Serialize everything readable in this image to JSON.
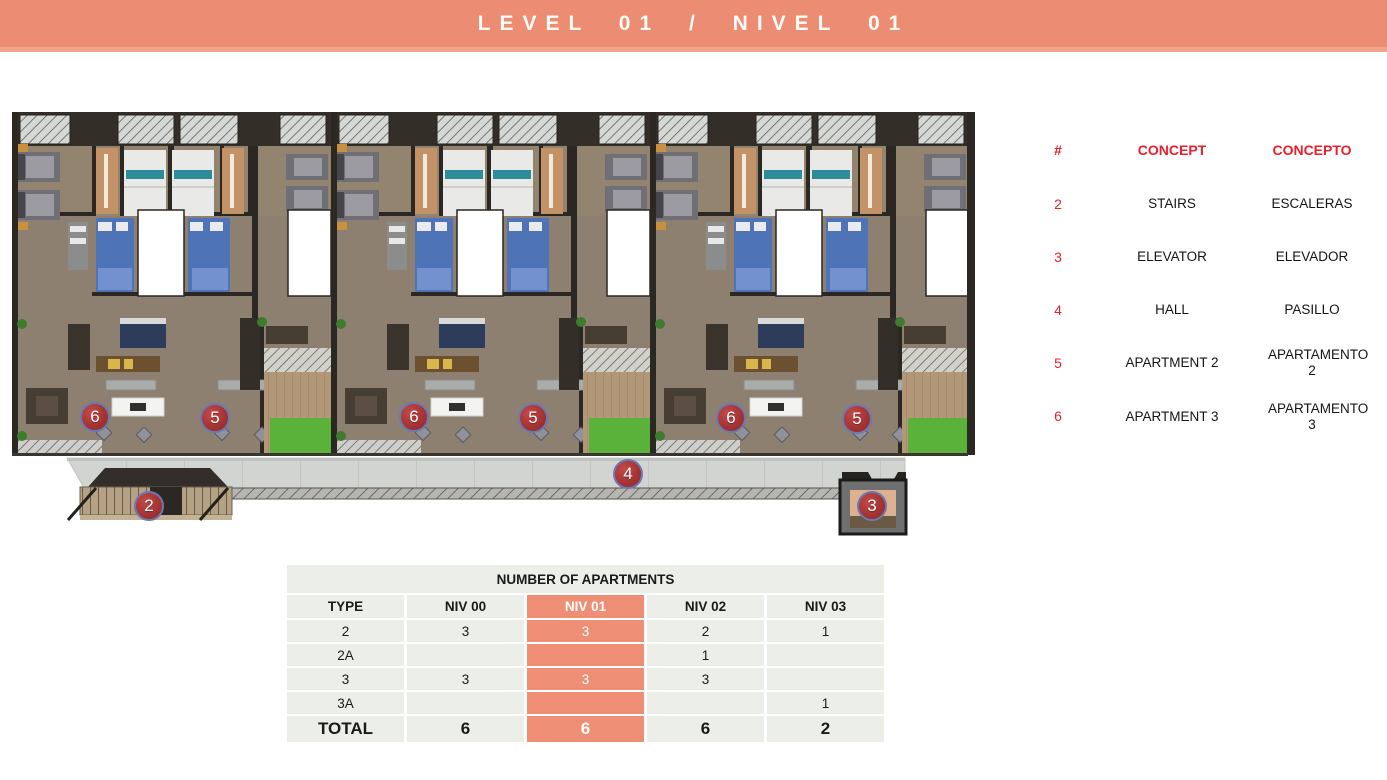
{
  "header": {
    "title": "LEVEL 01 / NIVEL 01"
  },
  "colors": {
    "accent_salmon": "#EC8C72",
    "highlight_salmon": "#EE8E74",
    "legend_red": "#E8202C",
    "marker_red": "#A33232",
    "marker_ring_blue": "#6A79B4",
    "table_cell_bg": "#ECEFE7"
  },
  "legend": {
    "headers": [
      "#",
      "CONCEPT",
      "CONCEPTO"
    ],
    "rows": [
      {
        "num": "2",
        "concept": "STAIRS",
        "concepto": "ESCALERAS"
      },
      {
        "num": "3",
        "concept": "ELEVATOR",
        "concepto": "ELEVADOR"
      },
      {
        "num": "4",
        "concept": "HALL",
        "concepto": "PASILLO"
      },
      {
        "num": "5",
        "concept": "APARTMENT 2",
        "concepto": "APARTAMENTO 2"
      },
      {
        "num": "6",
        "concept": "APARTMENT 3",
        "concepto": "APARTAMENTO 3"
      }
    ]
  },
  "floor_plan": {
    "markers": [
      {
        "label": "6"
      },
      {
        "label": "5"
      },
      {
        "label": "6"
      },
      {
        "label": "5"
      },
      {
        "label": "6"
      },
      {
        "label": "5"
      },
      {
        "label": "4"
      },
      {
        "label": "2"
      },
      {
        "label": "3"
      }
    ]
  },
  "apartments_table": {
    "title": "NUMBER OF APARTMENTS",
    "columns": [
      "TYPE",
      "NIV 00",
      "NIV 01",
      "NIV 02",
      "NIV 03"
    ],
    "highlighted_column": "NIV 01",
    "rows": [
      {
        "cells": [
          "2",
          "3",
          "3",
          "2",
          "1"
        ]
      },
      {
        "cells": [
          "2A",
          "",
          "",
          "1",
          ""
        ]
      },
      {
        "cells": [
          "3",
          "3",
          "3",
          "3",
          ""
        ]
      },
      {
        "cells": [
          "3A",
          "",
          "",
          "",
          "1"
        ]
      }
    ],
    "total": {
      "cells": [
        "TOTAL",
        "6",
        "6",
        "6",
        "2"
      ]
    }
  }
}
